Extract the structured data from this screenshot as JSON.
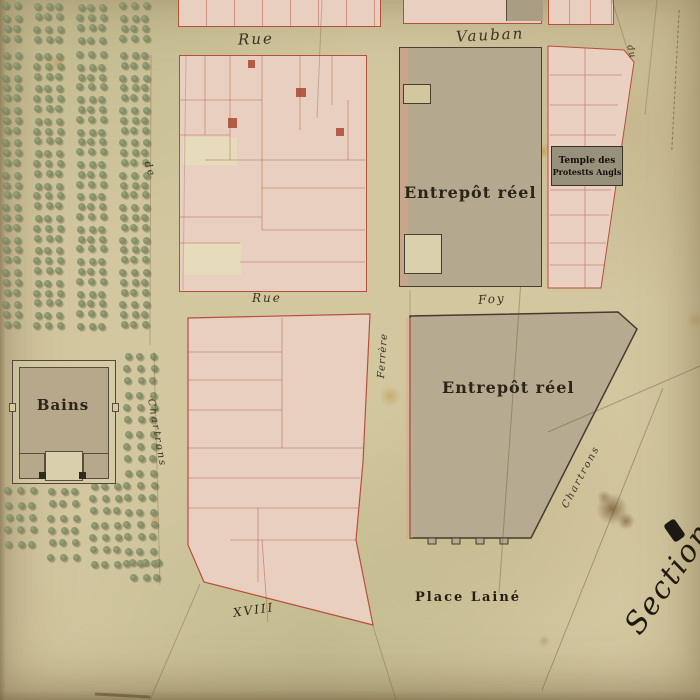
{
  "colors": {
    "paper": "#d3c7a0",
    "parcel_pink": "#e9cfbf",
    "parcel_red_line": "#b5503c",
    "building_grey": "#b4a88e",
    "ink": "#2b2518",
    "tree_green": "#76815c"
  },
  "labels": {
    "rue_top": "Rue",
    "vauban": "Vauban",
    "du": "du",
    "entrepot1": "Entrepôt réel",
    "entrepot2": "Entrepôt réel",
    "temple_line1": "Temple des",
    "temple_line2": "Protestts Angls",
    "rue_mid": "Rue",
    "foy": "Foy",
    "ferrere": "Ferrère",
    "de": "de",
    "chartres_left": "Chartrons",
    "chartrons_br": "Chartrons",
    "bains": "Bains",
    "place_laine": "Place Lainé",
    "section": "Section",
    "xviii": "XVIII"
  },
  "orchard": {
    "groups": [
      {
        "x": 3,
        "y": 3,
        "cols": 2,
        "rows": 4,
        "dx": 11,
        "dy": 11
      },
      {
        "x": 34,
        "y": 3,
        "cols": 3,
        "rows": 4,
        "dx": 11,
        "dy": 11
      },
      {
        "x": 77,
        "y": 3,
        "cols": 3,
        "rows": 4,
        "dx": 11,
        "dy": 11
      },
      {
        "x": 120,
        "y": 3,
        "cols": 3,
        "rows": 4,
        "dx": 11,
        "dy": 11
      },
      {
        "x": 3,
        "y": 52,
        "cols": 2,
        "rows": 26,
        "dx": 11,
        "dy": 10.8
      },
      {
        "x": 34,
        "y": 52,
        "cols": 3,
        "rows": 26,
        "dx": 11,
        "dy": 10.8
      },
      {
        "x": 77,
        "y": 52,
        "cols": 3,
        "rows": 26,
        "dx": 11,
        "dy": 10.8
      },
      {
        "x": 120,
        "y": 52,
        "cols": 3,
        "rows": 26,
        "dx": 11,
        "dy": 10.8
      },
      {
        "x": 124,
        "y": 352,
        "cols": 3,
        "rows": 17,
        "dx": 13,
        "dy": 13
      },
      {
        "x": 5,
        "y": 488,
        "cols": 3,
        "rows": 5,
        "dx": 12,
        "dy": 13
      },
      {
        "x": 48,
        "y": 488,
        "cols": 3,
        "rows": 6,
        "dx": 12,
        "dy": 13
      },
      {
        "x": 90,
        "y": 482,
        "cols": 3,
        "rows": 7,
        "dx": 12,
        "dy": 13
      },
      {
        "x": 130,
        "y": 560,
        "cols": 3,
        "rows": 2,
        "dx": 12,
        "dy": 13
      }
    ]
  },
  "parcel_numbers": [
    {
      "t": "58",
      "x": 265,
      "y": 8
    },
    {
      "t": "60",
      "x": 300,
      "y": 7
    },
    {
      "t": "68",
      "x": 342,
      "y": 9
    },
    {
      "t": "79",
      "x": 487,
      "y": 6
    },
    {
      "t": "63",
      "x": 206,
      "y": 62
    },
    {
      "t": "66",
      "x": 330,
      "y": 66
    },
    {
      "t": "61",
      "x": 214,
      "y": 97
    },
    {
      "t": "58",
      "x": 249,
      "y": 88
    },
    {
      "t": "57",
      "x": 338,
      "y": 100
    },
    {
      "t": "64",
      "x": 254,
      "y": 119
    },
    {
      "t": "47",
      "x": 317,
      "y": 127
    },
    {
      "t": "54",
      "x": 299,
      "y": 131
    },
    {
      "t": "52",
      "x": 344,
      "y": 161
    },
    {
      "t": "51",
      "x": 229,
      "y": 171
    },
    {
      "t": "48",
      "x": 237,
      "y": 217
    },
    {
      "t": "53",
      "x": 329,
      "y": 221
    },
    {
      "t": "45",
      "x": 211,
      "y": 246
    },
    {
      "t": "49",
      "x": 281,
      "y": 241
    },
    {
      "t": "79",
      "x": 591,
      "y": 94
    },
    {
      "t": "76",
      "x": 595,
      "y": 141
    },
    {
      "t": "73",
      "x": 593,
      "y": 189
    },
    {
      "t": "77",
      "x": 597,
      "y": 215
    },
    {
      "t": "78",
      "x": 591,
      "y": 239
    },
    {
      "t": "72",
      "x": 587,
      "y": 266
    },
    {
      "t": "71",
      "x": 468,
      "y": 119
    },
    {
      "t": "14",
      "x": 494,
      "y": 419
    },
    {
      "t": "74",
      "x": 209,
      "y": 347
    },
    {
      "t": "73",
      "x": 211,
      "y": 387
    },
    {
      "t": "77",
      "x": 250,
      "y": 430
    },
    {
      "t": "76",
      "x": 221,
      "y": 461
    },
    {
      "t": "73",
      "x": 255,
      "y": 479
    },
    {
      "t": "75",
      "x": 209,
      "y": 495
    },
    {
      "t": "78",
      "x": 205,
      "y": 523
    },
    {
      "t": "72",
      "x": 267,
      "y": 536
    },
    {
      "t": "71",
      "x": 299,
      "y": 550
    },
    {
      "t": "19",
      "x": 282,
      "y": 589
    },
    {
      "t": "21",
      "x": 342,
      "y": 591
    },
    {
      "t": "h",
      "x": 320,
      "y": 458,
      "s": 9
    },
    {
      "t": "D",
      "x": 335,
      "y": 494,
      "s": 9
    },
    {
      "t": "157",
      "x": 55,
      "y": 434
    }
  ],
  "stains": [
    {
      "x": 612,
      "y": 509,
      "r": 16,
      "c": "rgba(92,58,20,0.6)"
    },
    {
      "x": 626,
      "y": 521,
      "r": 9,
      "c": "rgba(92,58,20,0.5)"
    },
    {
      "x": 604,
      "y": 497,
      "r": 7,
      "c": "rgba(110,70,25,0.4)"
    },
    {
      "x": 390,
      "y": 396,
      "r": 11,
      "c": "rgba(190,140,55,0.45)"
    },
    {
      "x": 543,
      "y": 151,
      "r": 8,
      "c": "rgba(195,135,50,0.5)"
    },
    {
      "x": 57,
      "y": 63,
      "r": 9,
      "c": "rgba(180,130,60,0.33)"
    },
    {
      "x": 318,
      "y": 98,
      "r": 4,
      "c": "rgba(90,60,30,0.5)"
    },
    {
      "x": 544,
      "y": 641,
      "r": 6,
      "c": "rgba(150,110,60,0.35)"
    },
    {
      "x": 437,
      "y": 503,
      "r": 5,
      "c": "rgba(236,231,210,0.9)"
    },
    {
      "x": 155,
      "y": 520,
      "r": 5,
      "c": "rgba(170,120,60,0.35)"
    },
    {
      "x": 696,
      "y": 320,
      "r": 10,
      "c": "rgba(160,120,60,0.3)"
    }
  ],
  "lines": [
    {
      "x1": 322,
      "y1": 0,
      "x2": 317,
      "y2": 118,
      "o": 0.3,
      "w": 1
    },
    {
      "x1": 537,
      "y1": 52,
      "x2": 499,
      "y2": 593,
      "o": 0.38,
      "w": 1
    },
    {
      "x1": 151,
      "y1": 55,
      "x2": 150,
      "y2": 345,
      "o": 0.3,
      "w": 1
    },
    {
      "x1": 154,
      "y1": 352,
      "x2": 160,
      "y2": 585,
      "o": 0.3,
      "w": 1
    },
    {
      "x1": 186,
      "y1": 55,
      "x2": 183,
      "y2": 290,
      "o": 0.25,
      "w": 1
    },
    {
      "x1": 700,
      "y1": 366,
      "x2": 548,
      "y2": 432,
      "o": 0.4,
      "w": 1
    },
    {
      "x1": 663,
      "y1": 388,
      "x2": 542,
      "y2": 690,
      "o": 0.4,
      "w": 1
    },
    {
      "x1": 200,
      "y1": 584,
      "x2": 150,
      "y2": 700,
      "o": 0.32,
      "w": 1
    },
    {
      "x1": 373,
      "y1": 626,
      "x2": 396,
      "y2": 700,
      "o": 0.3,
      "w": 1
    },
    {
      "x1": 612,
      "y1": 0,
      "x2": 630,
      "y2": 58,
      "o": 0.3,
      "w": 1
    },
    {
      "x1": 657,
      "y1": 0,
      "x2": 645,
      "y2": 115,
      "o": 0.28,
      "w": 1
    },
    {
      "x1": 95,
      "y1": 694,
      "x2": 150,
      "y2": 697,
      "o": 0.6,
      "w": 3
    },
    {
      "x1": 410,
      "y1": 290,
      "x2": 410,
      "y2": 316,
      "o": 0.3,
      "w": 1
    }
  ]
}
